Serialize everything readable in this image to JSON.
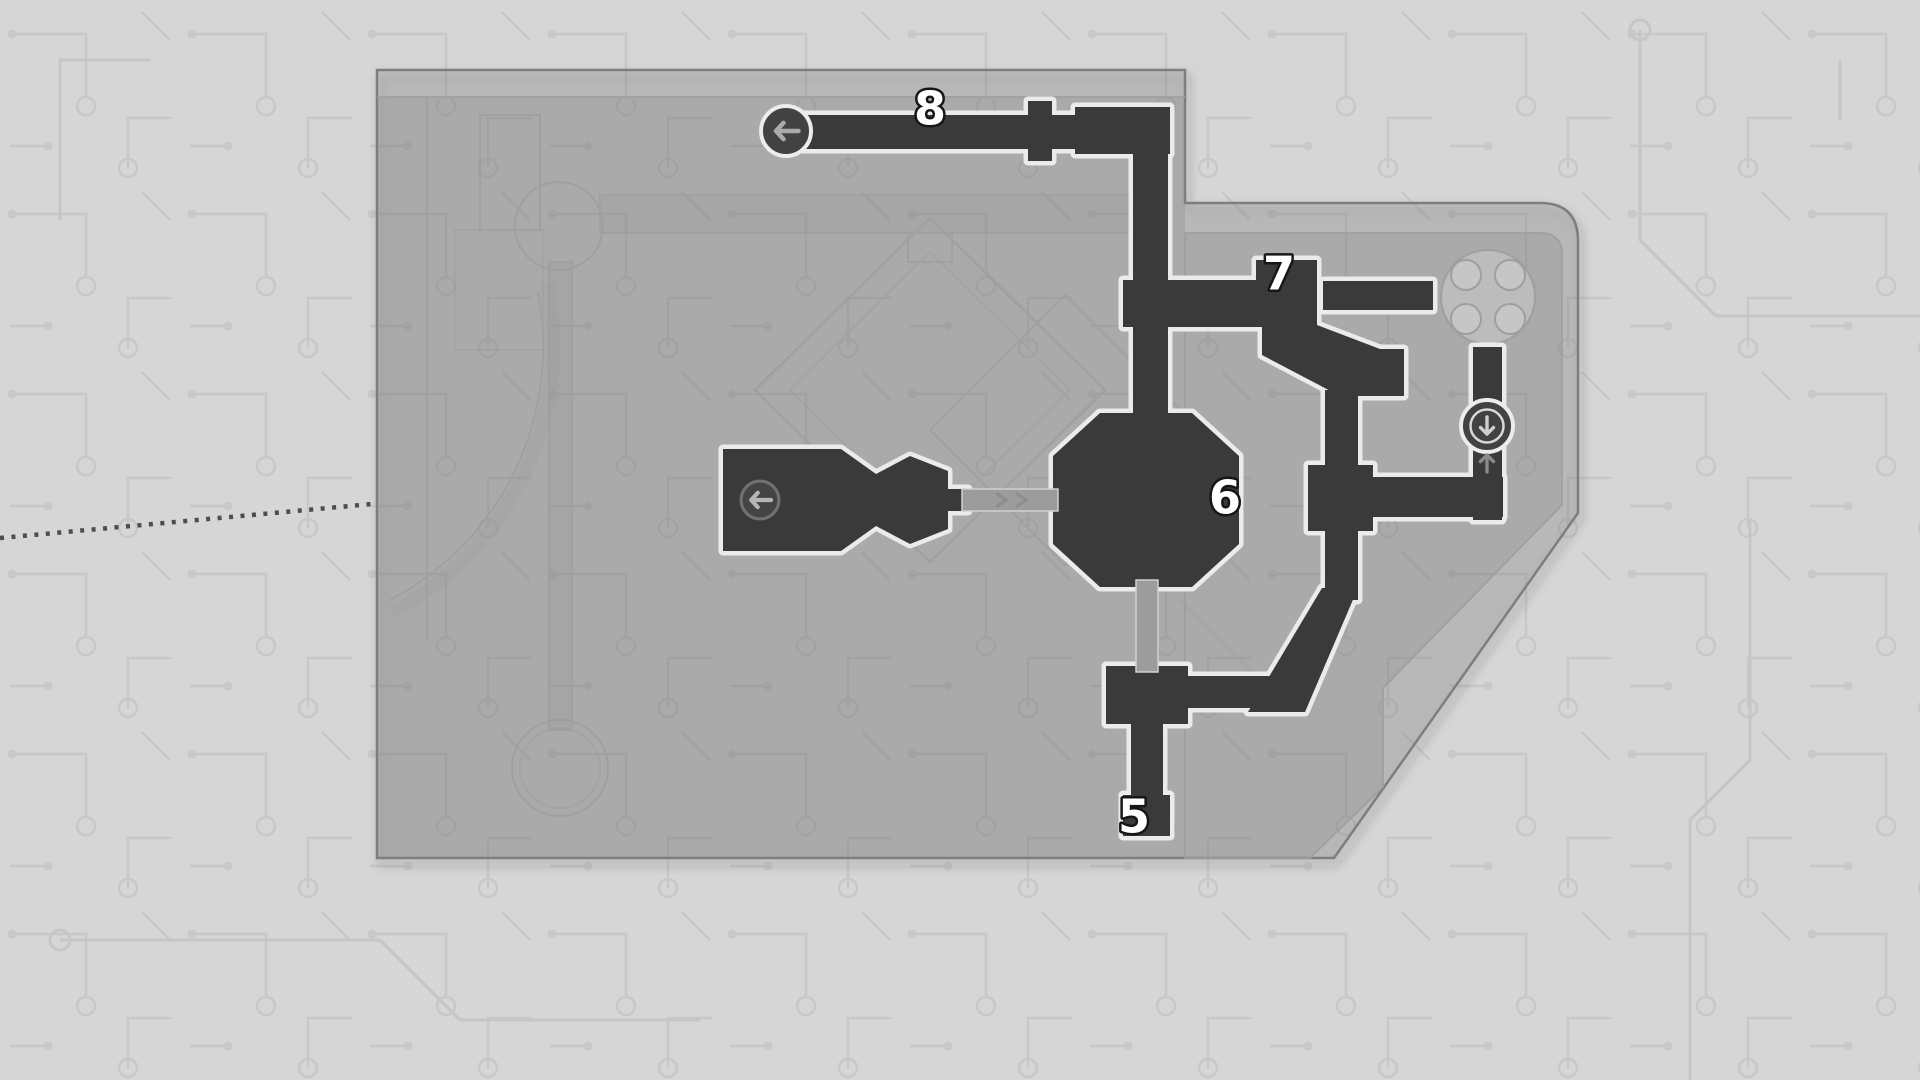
{
  "app": {
    "name": "game-level-map-screen"
  },
  "map": {
    "labels": [
      {
        "id": "point-8",
        "value": "8",
        "x": 930,
        "y": 108
      },
      {
        "id": "point-7",
        "value": "7",
        "x": 1279,
        "y": 273
      },
      {
        "id": "point-6",
        "value": "6",
        "x": 1225,
        "y": 497
      },
      {
        "id": "point-5",
        "value": "5",
        "x": 1134,
        "y": 816
      }
    ],
    "markers": [
      {
        "id": "exit-marker-top",
        "kind": "exit-circle",
        "icon": "arrow-left-icon",
        "x": 786,
        "y": 131
      },
      {
        "id": "exit-marker-room",
        "kind": "room-arrow",
        "icon": "arrow-left-icon",
        "x": 760,
        "y": 500
      },
      {
        "id": "elevator-marker",
        "kind": "elevator",
        "icon": "arrow-down-icon",
        "x": 1487,
        "y": 426
      },
      {
        "id": "elevator-up-hint",
        "kind": "up-hint",
        "icon": "arrow-up-icon",
        "x": 1487,
        "y": 463
      }
    ],
    "colors": {
      "page_bg": "#d6d6d6",
      "circuit_trace": "#c6c6c6",
      "base_fill": "rgba(125,125,125,0.24)",
      "inner_fill": "rgba(122,122,122,0.22)",
      "base_edge": "#7e7e7e",
      "detail_line": "#9f9f9f",
      "corridor": "#3a3a3a",
      "corridor_outline": "#ebebeb",
      "bridge": "#9c9c9c",
      "node_fill": "#424242",
      "node_ring": "#ececec",
      "arrow_light": "#aaaaaa",
      "arrow_dim": "#8a8a8a",
      "label_text": "#ffffff",
      "label_outline": "#161616",
      "dotted_line": "#4d4d4d"
    }
  }
}
